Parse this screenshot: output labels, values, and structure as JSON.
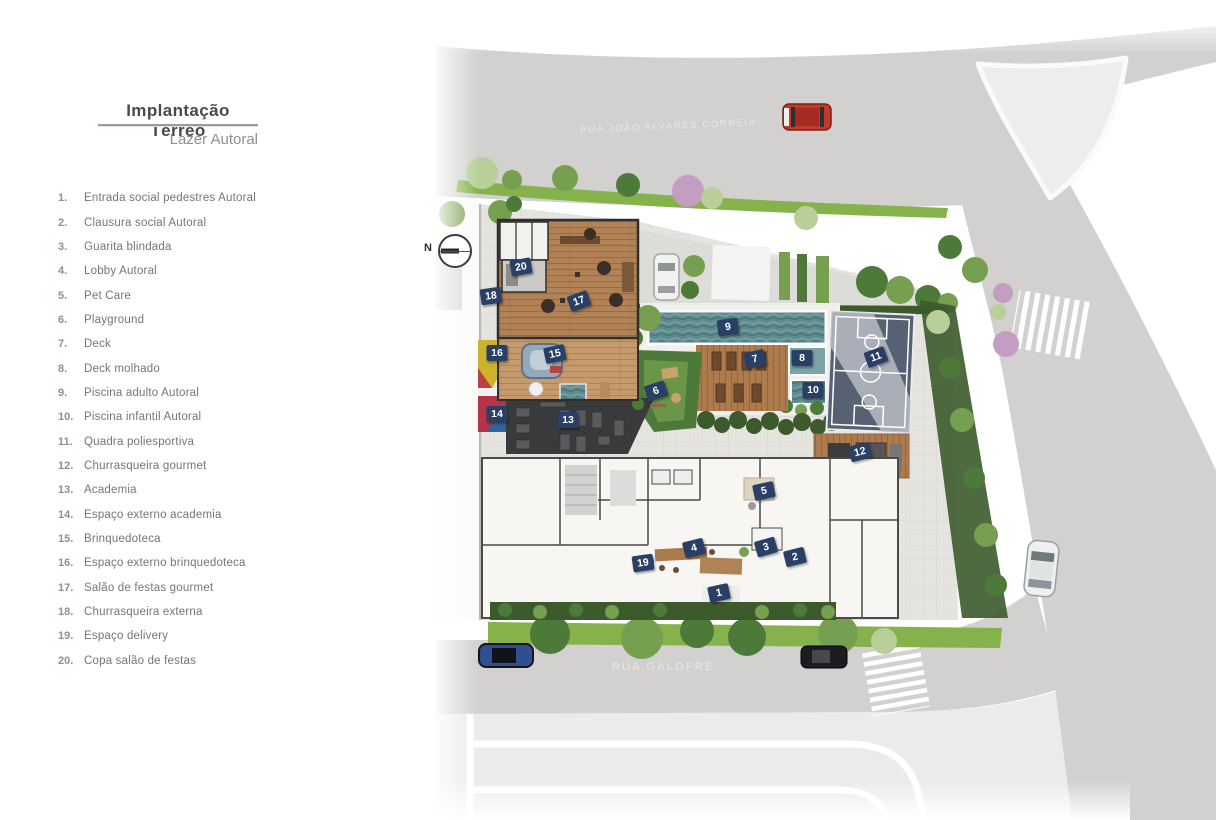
{
  "legend": {
    "title": "Implantação Térreo",
    "subtitle": "Lazer Autoral",
    "items": [
      {
        "num": "1.",
        "label": "Entrada social pedestres Autoral"
      },
      {
        "num": "2.",
        "label": "Clausura social Autoral"
      },
      {
        "num": "3.",
        "label": "Guarita blindada"
      },
      {
        "num": "4.",
        "label": "Lobby Autoral"
      },
      {
        "num": "5.",
        "label": "Pet  Care"
      },
      {
        "num": "6.",
        "label": "Playground"
      },
      {
        "num": "7.",
        "label": "Deck"
      },
      {
        "num": "8.",
        "label": "Deck molhado"
      },
      {
        "num": "9.",
        "label": "Piscina adulto Autoral"
      },
      {
        "num": "10.",
        "label": "Piscina infantil Autoral"
      },
      {
        "num": "11.",
        "label": "Quadra poliesportiva"
      },
      {
        "num": "12.",
        "label": "Churrasqueira gourmet"
      },
      {
        "num": "13.",
        "label": "Academia"
      },
      {
        "num": "14.",
        "label": "Espaço externo academia"
      },
      {
        "num": "15.",
        "label": "Brinquedoteca"
      },
      {
        "num": "16.",
        "label": "Espaço externo brinquedoteca"
      },
      {
        "num": "17.",
        "label": "Salão de festas gourmet"
      },
      {
        "num": "18.",
        "label": "Churrasqueira externa"
      },
      {
        "num": "19.",
        "label": "Espaço delivery"
      },
      {
        "num": "20.",
        "label": "Copa salão de festas"
      }
    ]
  },
  "plan": {
    "north_label": "N",
    "streets": [
      {
        "id": "rua-joao-alvares-correia",
        "name": "RUA JOÃO ALVARES CORREIA"
      },
      {
        "id": "rua-garapeba",
        "name": "RUA GARAPEBA"
      },
      {
        "id": "rua-galofre",
        "name": "RUA GALOFRE"
      }
    ],
    "markers": [
      {
        "n": "1",
        "x": 719,
        "y": 593,
        "rot": -12
      },
      {
        "n": "2",
        "x": 795,
        "y": 557,
        "rot": -14
      },
      {
        "n": "3",
        "x": 766,
        "y": 547,
        "rot": -16
      },
      {
        "n": "4",
        "x": 694,
        "y": 548,
        "rot": -14
      },
      {
        "n": "5",
        "x": 764,
        "y": 491,
        "rot": -12
      },
      {
        "n": "6",
        "x": 656,
        "y": 391,
        "rot": -18
      },
      {
        "n": "7",
        "x": 755,
        "y": 359,
        "rot": -14
      },
      {
        "n": "8",
        "x": 802,
        "y": 358,
        "rot": 0
      },
      {
        "n": "9",
        "x": 728,
        "y": 327,
        "rot": -8
      },
      {
        "n": "10",
        "x": 813,
        "y": 390,
        "rot": 0
      },
      {
        "n": "11",
        "x": 876,
        "y": 357,
        "rot": -20
      },
      {
        "n": "12",
        "x": 860,
        "y": 452,
        "rot": -14
      },
      {
        "n": "13",
        "x": 568,
        "y": 420,
        "rot": 0
      },
      {
        "n": "14",
        "x": 497,
        "y": 414,
        "rot": 0
      },
      {
        "n": "15",
        "x": 555,
        "y": 354,
        "rot": -12
      },
      {
        "n": "16",
        "x": 497,
        "y": 353,
        "rot": 0
      },
      {
        "n": "17",
        "x": 579,
        "y": 301,
        "rot": -20
      },
      {
        "n": "18",
        "x": 491,
        "y": 296,
        "rot": -8
      },
      {
        "n": "19",
        "x": 643,
        "y": 563,
        "rot": -8
      },
      {
        "n": "20",
        "x": 521,
        "y": 267,
        "rot": -10
      }
    ],
    "colors": {
      "accent_marker": "#2a3f66",
      "road": "#d2d1cf",
      "island": "#ededeb",
      "parking": "#ecebe9",
      "green_strip": "#86b24c",
      "hedge": "#3c5a2c",
      "tree_dark": "#4d7a39",
      "tree_light": "#76a050",
      "tree_pale": "#b9cf9a",
      "tree_pink": "#c39ec2",
      "pool_water": "#5d8b8e",
      "wood": "#b28257",
      "wood_light": "#c59a6d",
      "deck_wood": "#ad7b4e",
      "gym_floor": "#3a3a3c",
      "court": "#566173",
      "court_light": "#b7bdc5",
      "pavers": "#e6e4df",
      "building_floor": "#f7f6f3",
      "wall": "#3f3f3f",
      "legend_number": "#9b8e80",
      "legend_text": "#757575",
      "title_text": "#4a4a4a",
      "street_text": "#e7e7e5"
    }
  }
}
